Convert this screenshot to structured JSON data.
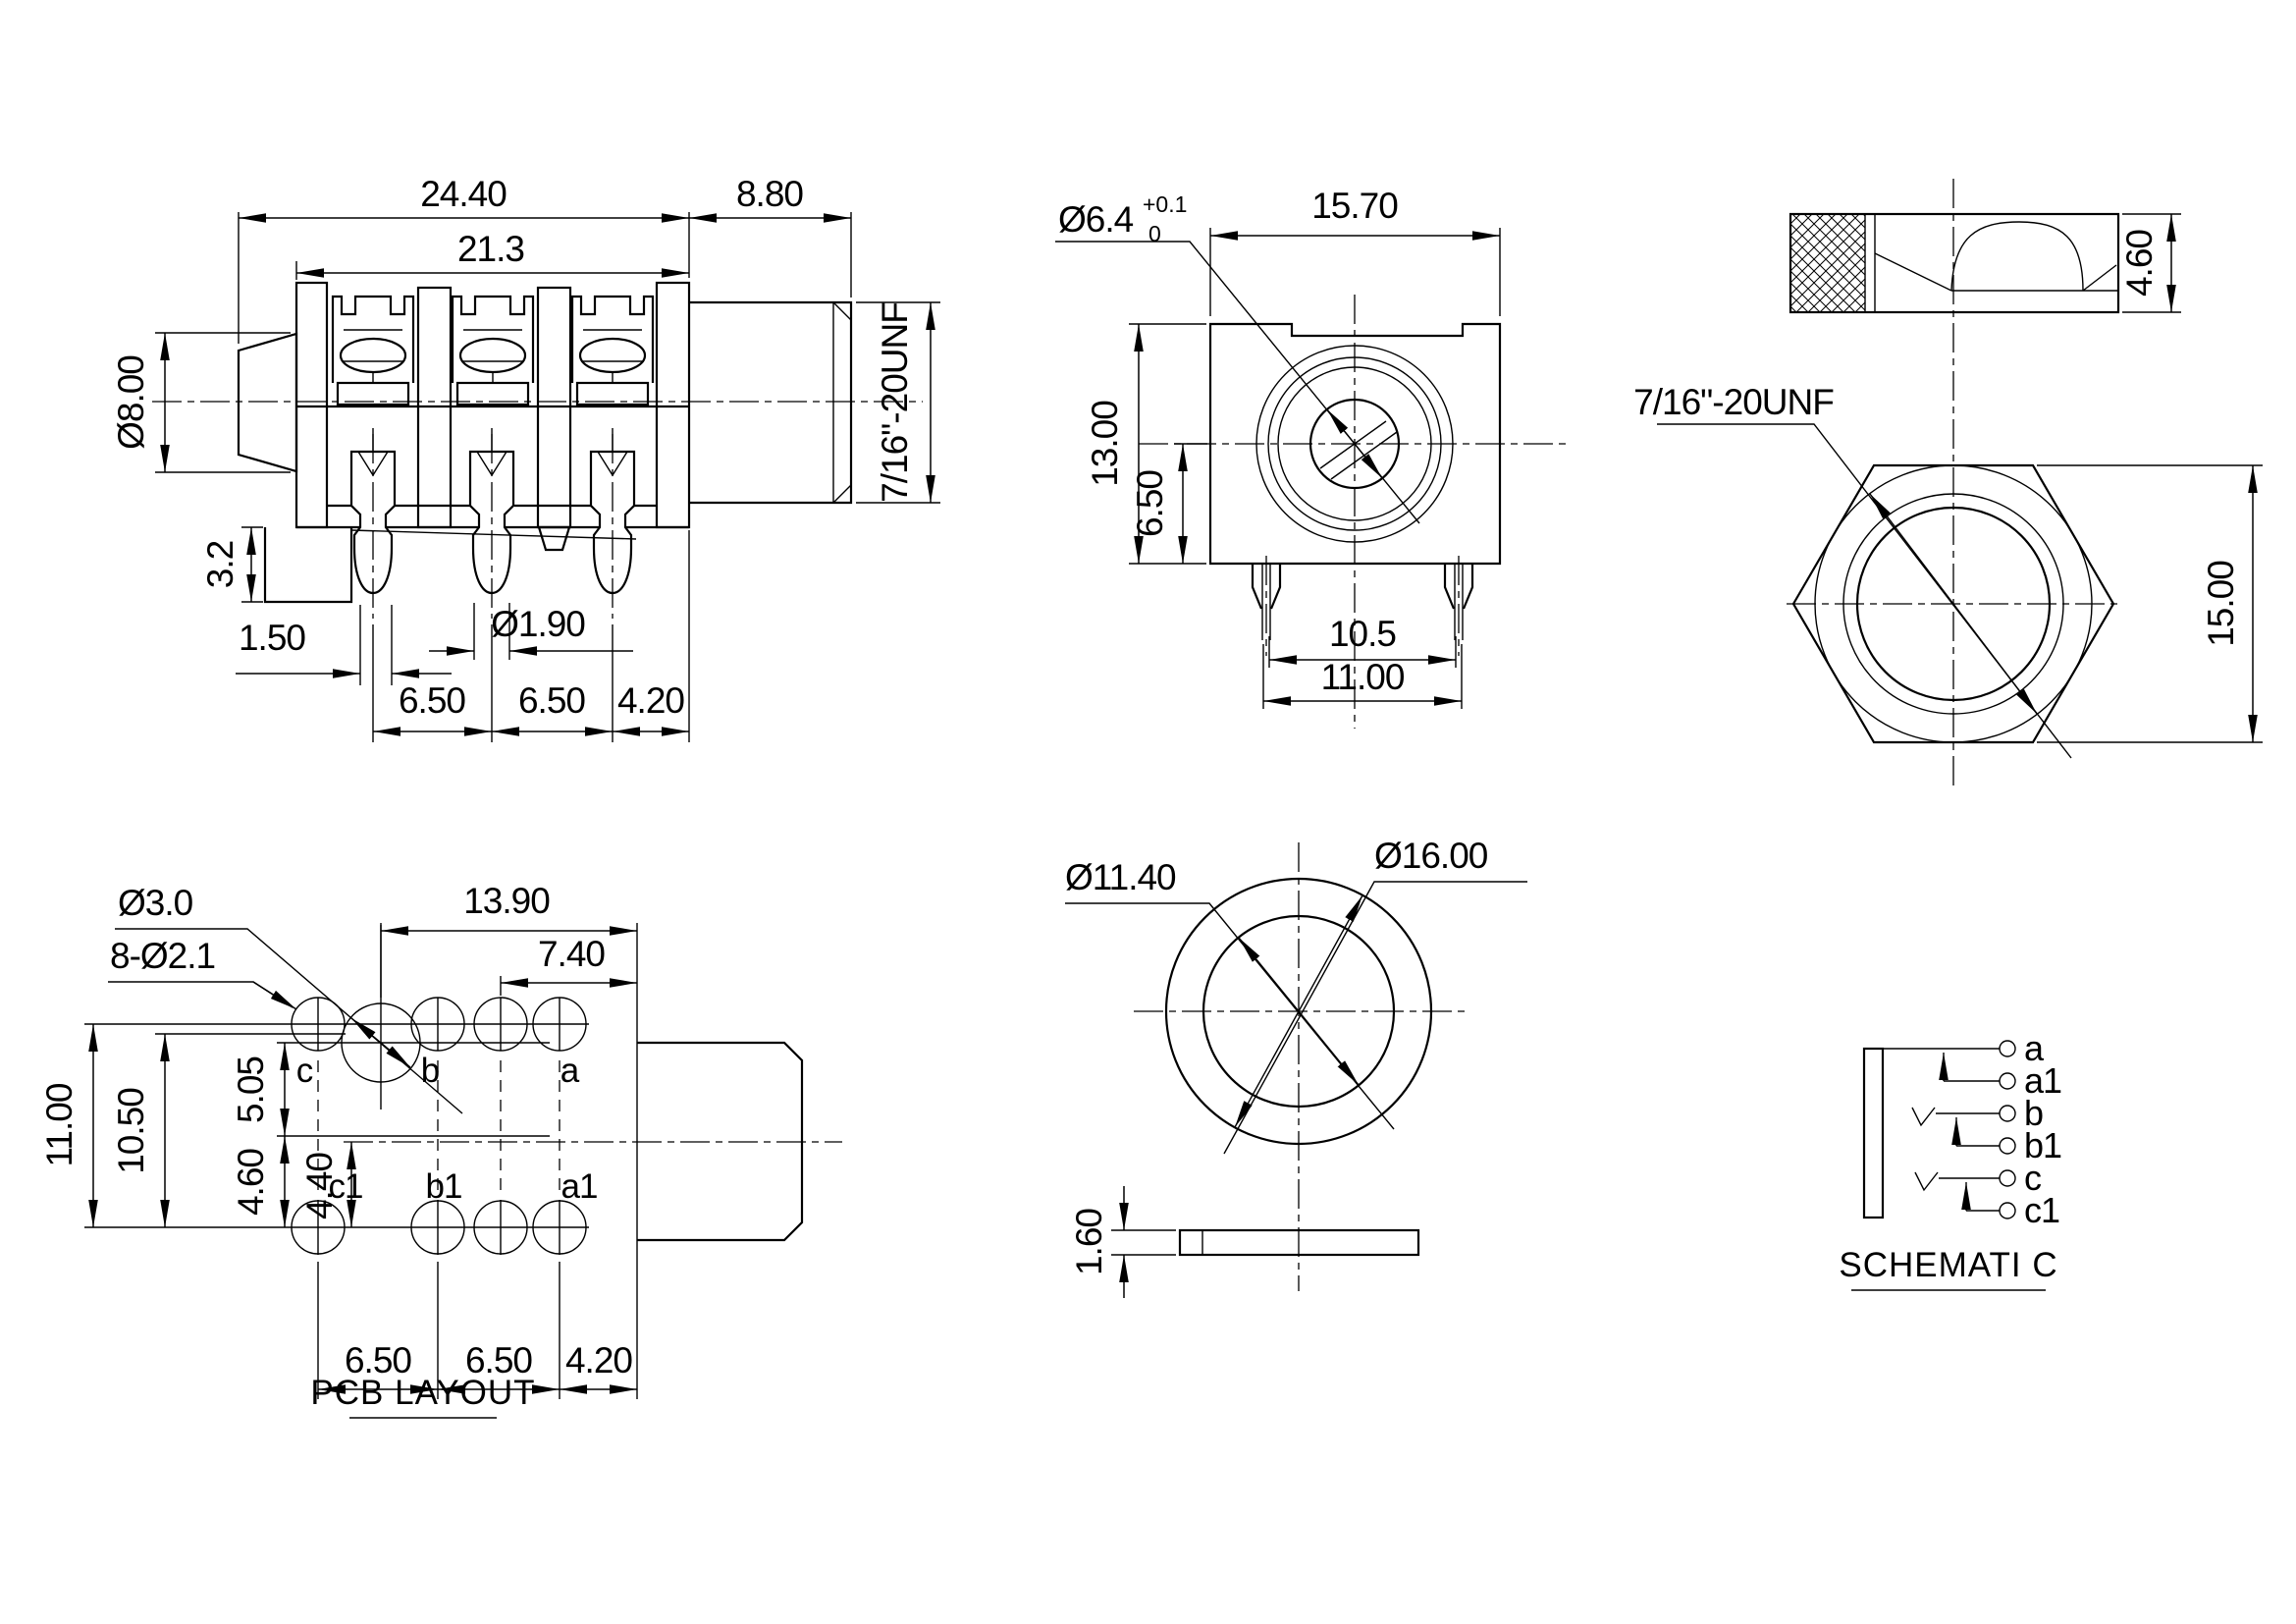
{
  "views": {
    "side": {
      "dims": {
        "total_width": "24.40",
        "body_width": "21.3",
        "thread_length": "8.80",
        "bushing_dia": "Ø8.00",
        "thread_spec": "7/16\"-20UNF",
        "step_height": "3.2",
        "pin_offset": "1.50",
        "pin_dia": "Ø1.90",
        "pitch_1": "6.50",
        "pitch_2": "6.50",
        "pitch_3": "4.20"
      }
    },
    "front": {
      "dims": {
        "bore_dia": "Ø6.4",
        "bore_tol_upper": "+0.1",
        "bore_tol_lower": "0",
        "width": "15.70",
        "height": "13.00",
        "center_height": "6.50",
        "peg_span_inner": "10.5",
        "peg_span_outer": "11.00"
      }
    },
    "nut": {
      "dims": {
        "thickness": "4.60",
        "thread_spec": "7/16\"-20UNF",
        "across_flats": "15.00"
      }
    },
    "pcb": {
      "title": "PCB LAYOUT",
      "dims": {
        "big_hole_dia": "Ø3.0",
        "small_holes": "8-Ø2.1",
        "col_span_1": "13.90",
        "col_span_2": "7.40",
        "row_span_1": "11.00",
        "row_span_2": "10.50",
        "upper_offset": "5.05",
        "lower_offset_1": "4.60",
        "lower_offset_2": "4.40",
        "pitch_1": "6.50",
        "pitch_2": "6.50",
        "pitch_3": "4.20"
      },
      "pads": {
        "c": "c",
        "b": "b",
        "a": "a",
        "c1": "c1",
        "b1": "b1",
        "a1": "a1"
      }
    },
    "washer": {
      "dims": {
        "inner_dia": "Ø11.40",
        "outer_dia": "Ø16.00",
        "thickness": "1.60"
      }
    },
    "schematic": {
      "title": "SCHEMATI C",
      "pins": [
        "a",
        "a1",
        "b",
        "b1",
        "c",
        "c1"
      ]
    }
  }
}
